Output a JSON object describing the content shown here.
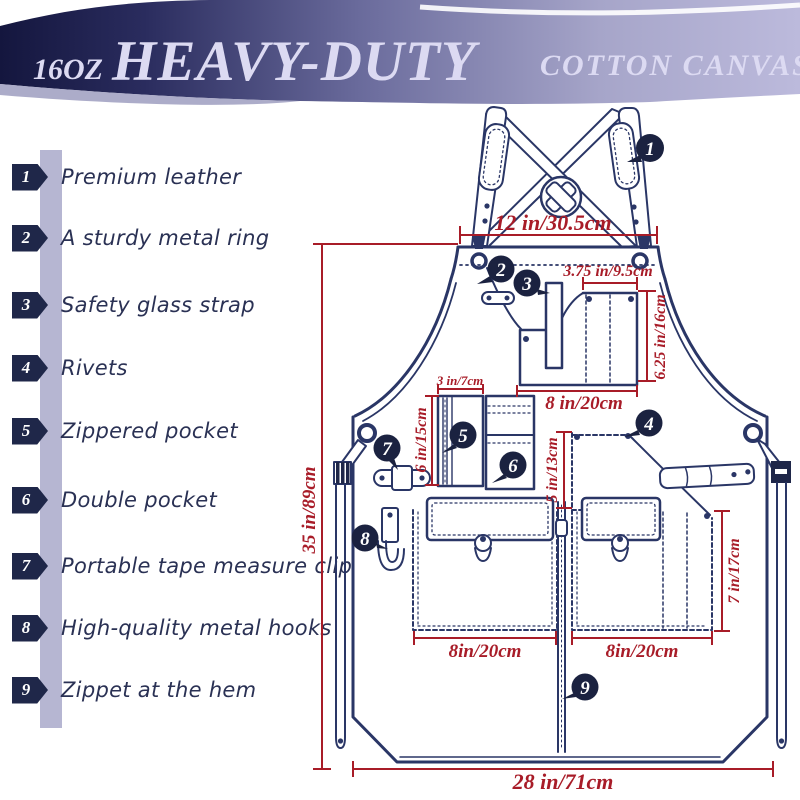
{
  "banner": {
    "weight": "16OZ",
    "title": "HEAVY-DUTY",
    "subtitle": "COTTON CANVAS"
  },
  "features": [
    {
      "num": "1",
      "label": "Premium leather"
    },
    {
      "num": "2",
      "label": "A sturdy metal ring"
    },
    {
      "num": "3",
      "label": "Safety glass strap"
    },
    {
      "num": "4",
      "label": "Rivets"
    },
    {
      "num": "5",
      "label": "Zippered pocket"
    },
    {
      "num": "6",
      "label": "Double pocket"
    },
    {
      "num": "7",
      "label": "Portable tape measure clip"
    },
    {
      "num": "8",
      "label": "High-quality metal hooks"
    },
    {
      "num": "9",
      "label": "Zippet at the hem"
    }
  ],
  "measurements": {
    "neck_width": "12 in/30.5cm",
    "chest_pocket_top": "3.75 in/9.5cm",
    "chest_pocket_side": "6.25 in/16cm",
    "chest_pocket_bottom": "8 in/20cm",
    "zip_pocket_top": "3 in/7cm",
    "zip_pocket_side": "6 in/15cm",
    "center_gap": "5 in/13cm",
    "apron_length": "35 in/89cm",
    "lower_pocket_side": "7 in/17cm",
    "lower_left_width": "8in/20cm",
    "lower_right_width": "8in/20cm",
    "hem_width": "28 in/71cm"
  },
  "colors": {
    "accent_red": "#A81C28",
    "line_navy": "#2A3666",
    "badge_navy": "#1F2749",
    "banner_dark": "#14163E",
    "banner_light": "#BCBADC",
    "bar_lavender": "#B6B6D2",
    "text_navy": "#2A3154"
  }
}
